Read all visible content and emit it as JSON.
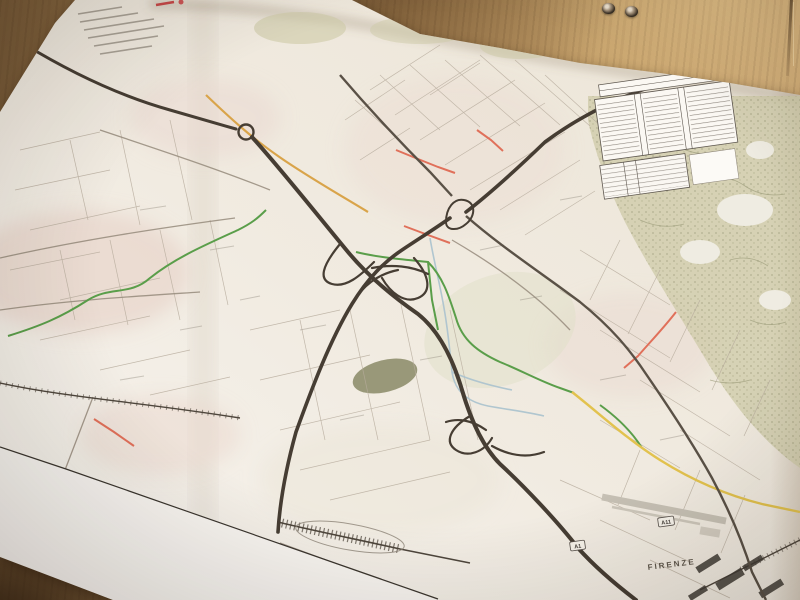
{
  "photo": {
    "table": {
      "material": "wood",
      "colors": {
        "light": "#cfab76",
        "mid": "#95754a",
        "dark": "#6b5133"
      },
      "grommet_count": 2
    },
    "paper_color": "#f3eee6"
  },
  "map": {
    "labels": [
      {
        "text": "FIRENZE"
      }
    ],
    "shields": [
      {
        "text": "A1"
      },
      {
        "text": "A11"
      }
    ],
    "legend": {
      "column_groups": 3
    },
    "colors": {
      "road_major": "#463d33",
      "road_secondary": "#5a5146",
      "route_green": "#5a9e4a",
      "route_orange": "#d9a44a",
      "route_red": "#e0705a",
      "route_yellow": "#e2c24e",
      "river_blue": "#a9c2ce",
      "urban_tint": "#e7d2c8",
      "vegetation_tint": "#cdcaa7"
    }
  }
}
